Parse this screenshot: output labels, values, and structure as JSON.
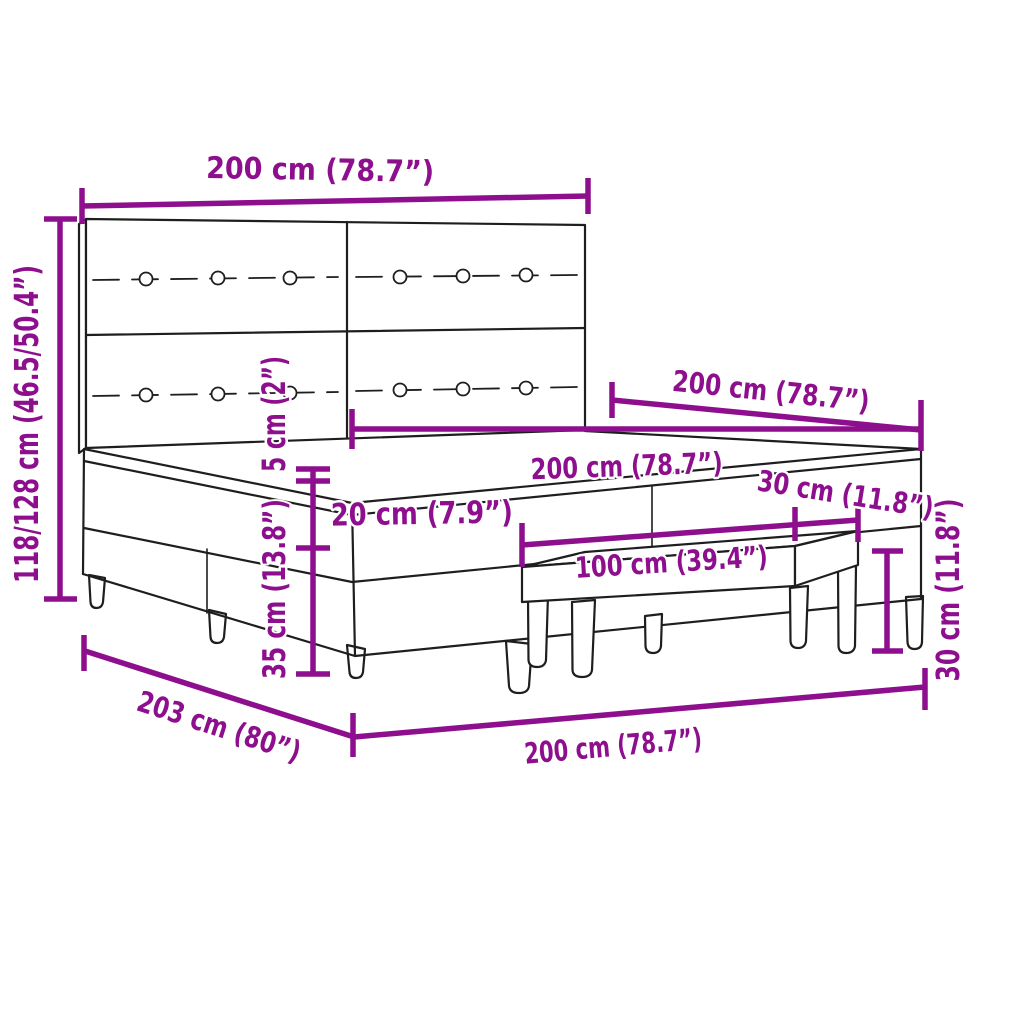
{
  "colors": {
    "dimension": "#8E0F8E",
    "outline": "#1E1E1E",
    "background": "#FFFFFF"
  },
  "labels": {
    "headboard_width": "200 cm (78.7”)",
    "total_height": "118/128 cm (46.5/50.4”)",
    "topper_height": "5 cm (2”)",
    "mattress_height": "20 cm (7.9”)",
    "base_height": "35 cm (13.8”)",
    "mattress_width": "200 cm (78.7”)",
    "bed_depth": "200 cm (78.7”)",
    "bench_depth": "30 cm (11.8”)",
    "bench_width": "100 cm (39.4”)",
    "bench_height": "30 cm (11.8”)",
    "frame_depth": "203 cm (80”)",
    "frame_width": "200 cm (78.7”)"
  }
}
